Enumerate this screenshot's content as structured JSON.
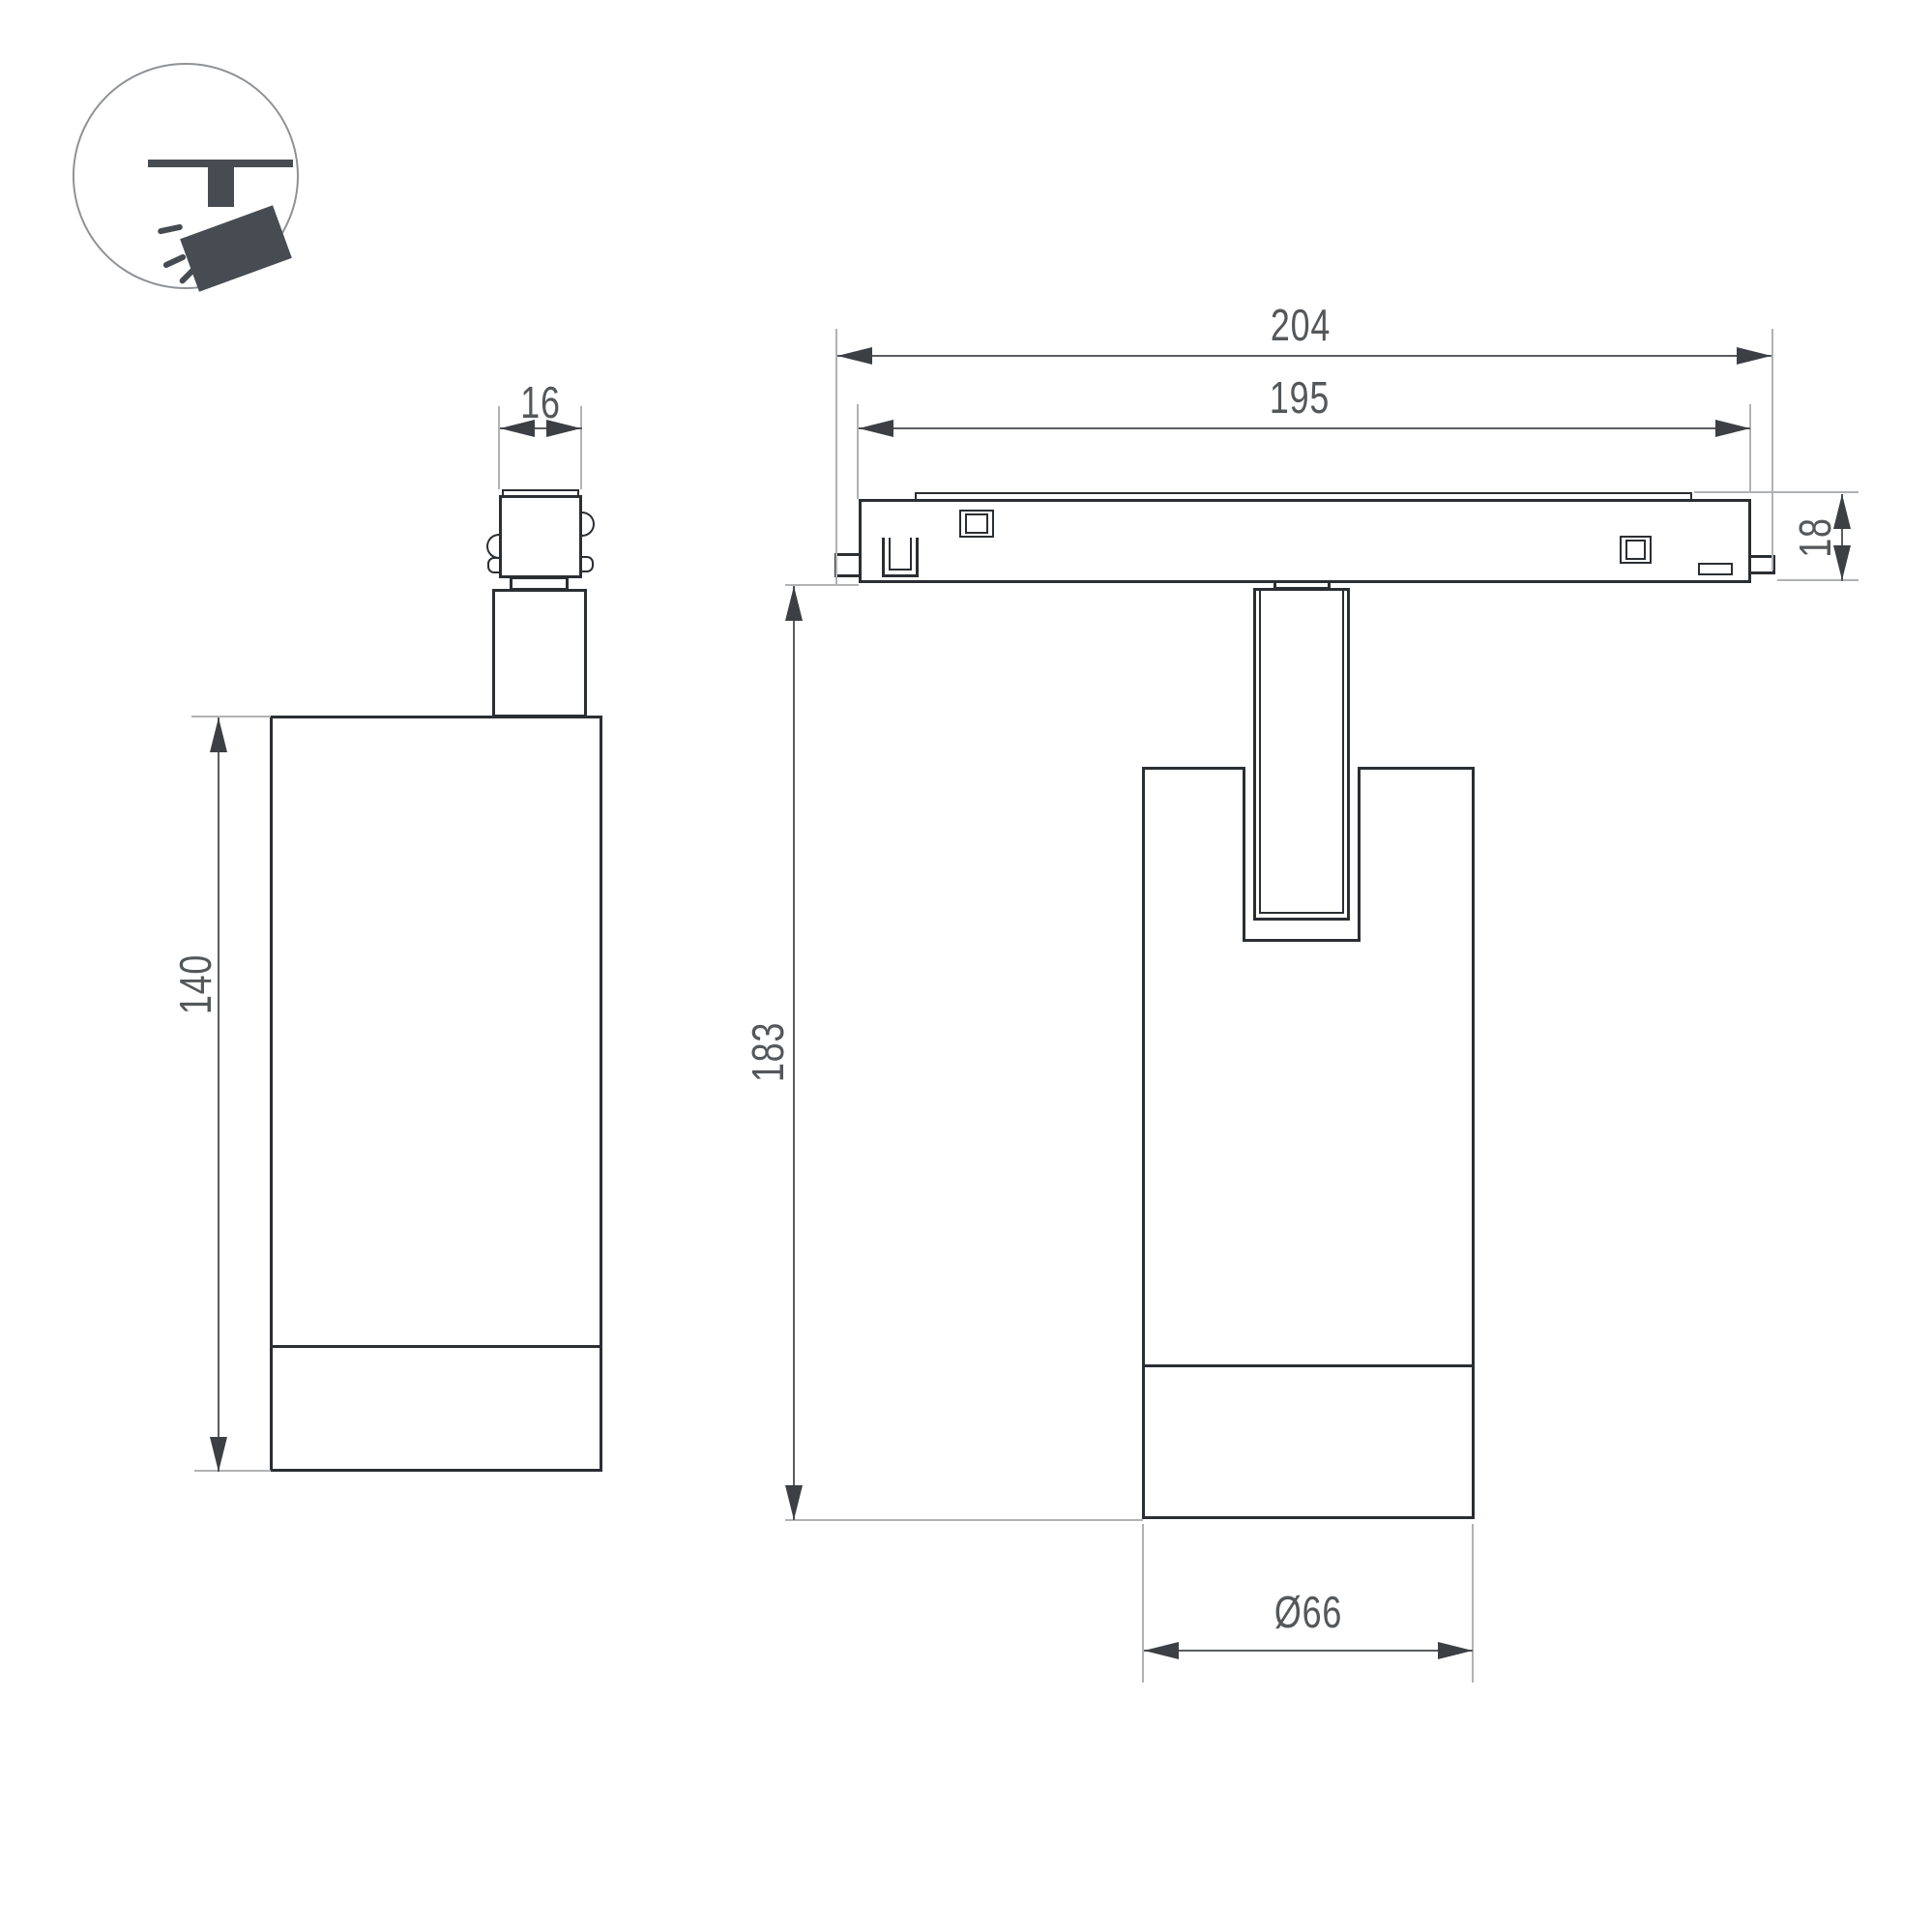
{
  "views": {
    "side_view": {
      "dimensions": {
        "connector_width": "16",
        "body_height": "140"
      }
    },
    "front_view": {
      "dimensions": {
        "overall_length": "204",
        "track_length": "195",
        "track_height": "18",
        "overall_height": "183",
        "body_diameter": "Ø66"
      }
    }
  },
  "icons": [
    {
      "name": "track-spotlight-icon"
    }
  ],
  "colors": {
    "outline": "#2b2e33",
    "dimension_line": "#5a5d60",
    "extension_line": "#b0b2b4",
    "label_text": "#55585a",
    "icon_fill": "#474c52",
    "background": "#ffffff"
  }
}
